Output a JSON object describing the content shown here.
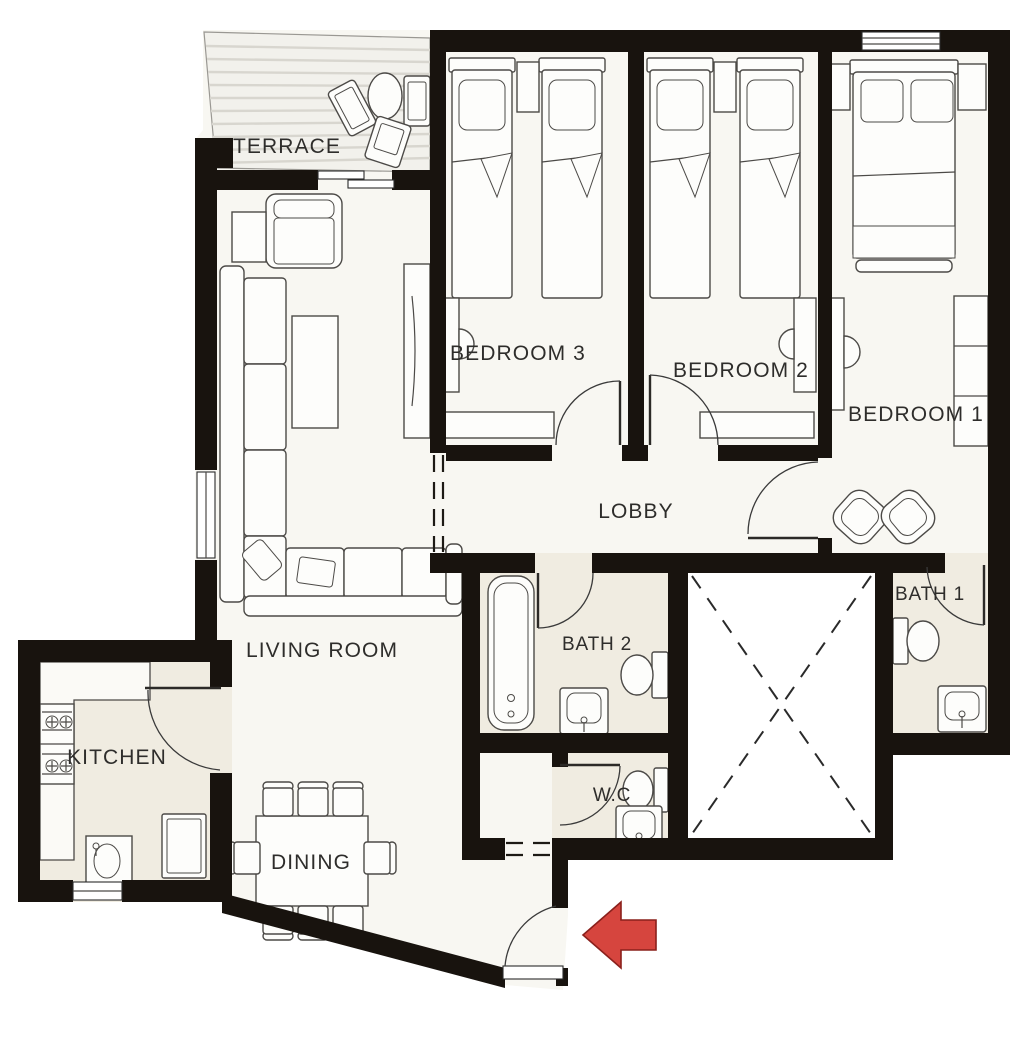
{
  "rooms": {
    "terrace": {
      "label": "TERRACE",
      "furniture": [
        "outdoor-table-icon",
        "outdoor-chair-icon",
        "outdoor-chair-icon",
        "outdoor-chair-icon"
      ]
    },
    "bedroom3": {
      "label": "BEDROOM 3",
      "furniture": [
        "single-bed-icon",
        "single-bed-icon",
        "nightstand-icon",
        "desk-icon",
        "desk-chair-icon",
        "dresser-icon"
      ]
    },
    "bedroom2": {
      "label": "BEDROOM 2",
      "furniture": [
        "single-bed-icon",
        "single-bed-icon",
        "nightstand-icon",
        "desk-icon",
        "desk-chair-icon",
        "dresser-icon"
      ]
    },
    "bedroom1": {
      "label": "BEDROOM 1",
      "furniture": [
        "double-bed-icon",
        "nightstand-icon",
        "nightstand-icon",
        "desk-icon",
        "desk-chair-icon",
        "wardrobe-icon",
        "pouf-icon",
        "pouf-icon"
      ]
    },
    "lobby": {
      "label": "LOBBY",
      "furniture": []
    },
    "living_room": {
      "label": "LIVING ROOM",
      "furniture": [
        "sectional-sofa-icon",
        "coffee-table-icon",
        "armchair-icon",
        "side-table-icon",
        "tv-console-icon"
      ]
    },
    "dining": {
      "label": "DINING",
      "furniture": [
        "dining-table-icon",
        "chair-icon",
        "chair-icon",
        "chair-icon",
        "chair-icon",
        "chair-icon",
        "chair-icon",
        "chair-icon",
        "chair-icon"
      ]
    },
    "kitchen": {
      "label": "KITCHEN",
      "furniture": [
        "counter-icon",
        "stove-icon",
        "kitchen-sink-icon",
        "fridge-icon"
      ]
    },
    "bath2": {
      "label": "BATH 2",
      "furniture": [
        "bathtub-icon",
        "sink-icon",
        "toilet-icon"
      ]
    },
    "bath1": {
      "label": "BATH 1",
      "furniture": [
        "toilet-icon",
        "sink-icon"
      ]
    },
    "wc": {
      "label": "W.C",
      "furniture": [
        "toilet-icon",
        "sink-icon"
      ]
    }
  },
  "entrance": {
    "arrow_direction": "left"
  },
  "colors": {
    "wall": "#18130e",
    "floor": "#f8f7f2",
    "floor_wet": "#f0ece1",
    "terrace_floor": "#f2f1ec",
    "terrace_stripe": "#d8d6cf",
    "shaft": "#ffffff",
    "label": "#2e2d2b",
    "arrow": "#d6453e",
    "arrow_outline": "#8a201c"
  }
}
